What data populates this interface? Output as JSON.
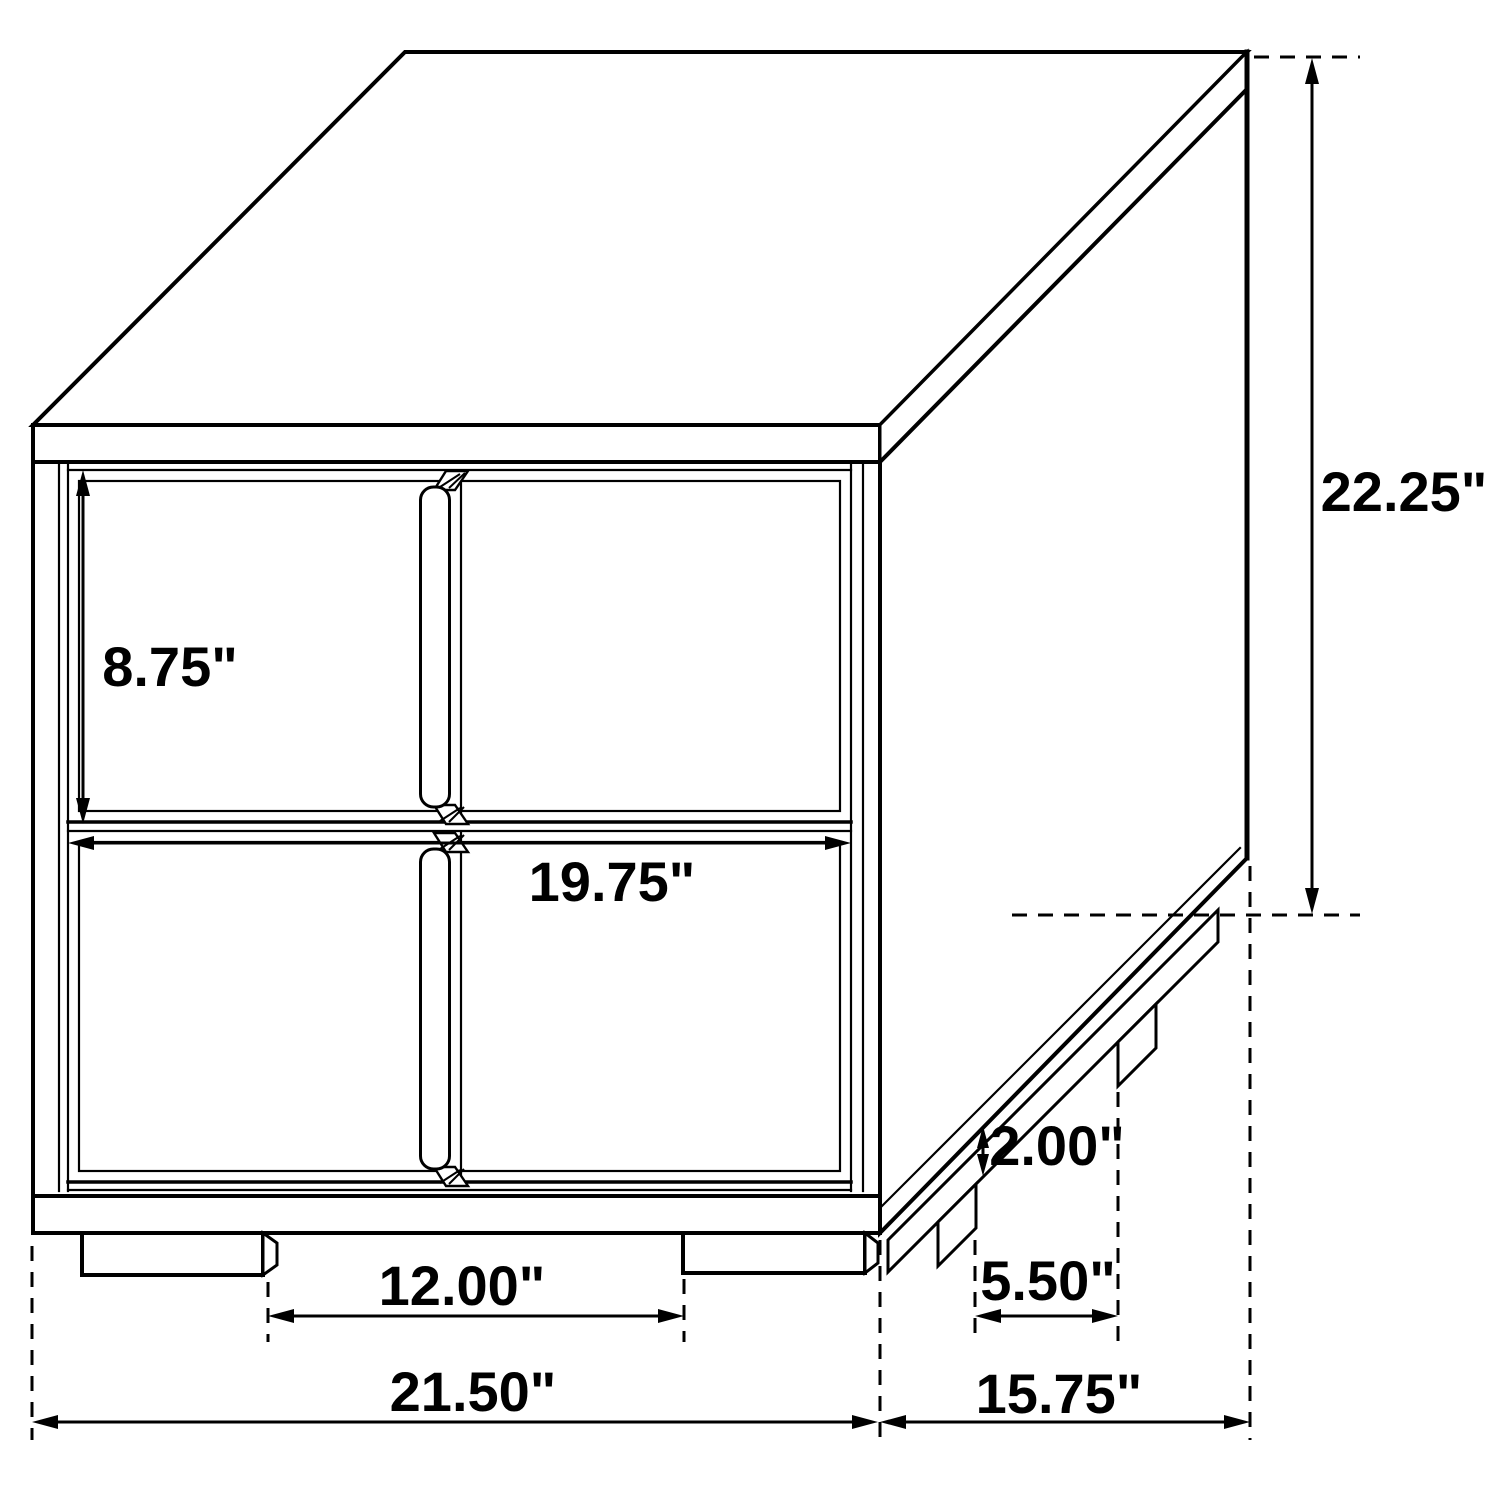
{
  "figure": {
    "type": "furniture-dimension-diagram",
    "subject": "Two-drawer nightstand, isometric technical line drawing with dimension callouts",
    "units": "inches",
    "colors": {
      "background": "#ffffff",
      "line": "#000000",
      "text": "#000000"
    },
    "dimensions": {
      "overall_height": "22.25\"",
      "drawer_height": "8.75\"",
      "drawer_width": "19.75\"",
      "front_feet_spacing": "12.00\"",
      "overall_width": "21.50\"",
      "overall_depth": "15.75\"",
      "side_feet_gap": "5.50\"",
      "foot_height": "2.00\""
    }
  }
}
